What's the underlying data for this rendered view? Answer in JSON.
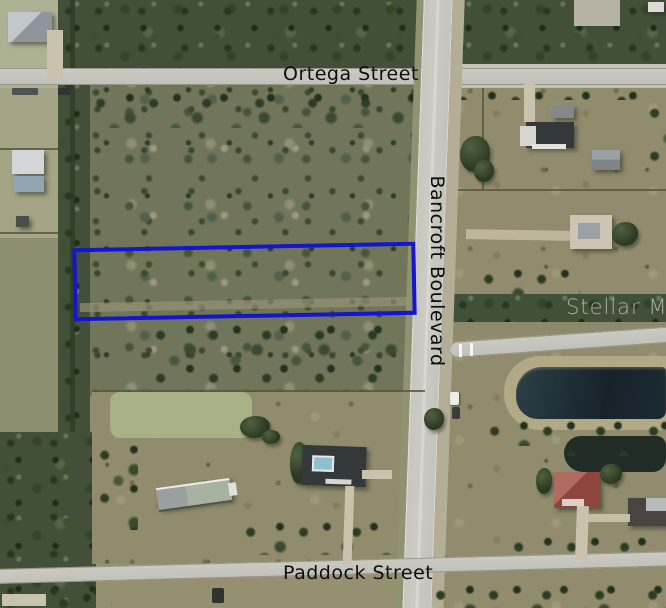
{
  "map": {
    "type": "aerial-satellite-photo",
    "street_labels": {
      "top": "Ortega Street",
      "vertical": "Bancroft Boulevard",
      "bottom": "Paddock Street"
    },
    "watermark": "Stellar MLS",
    "parcel_outline_color": "#1315cf",
    "label_color": "#0d0d0d",
    "features": [
      "highlighted-parcel",
      "scrub-forest",
      "pond",
      "canal-tree-line",
      "pasture",
      "houses",
      "barn"
    ]
  }
}
